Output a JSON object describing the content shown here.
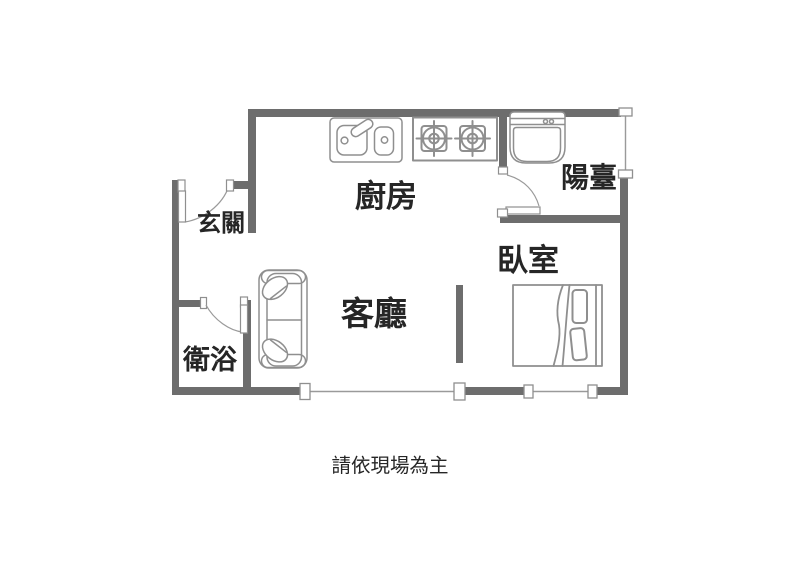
{
  "colors": {
    "wall": "#6d6d6d",
    "fixture": "#8f8f8f",
    "window": "#9a9a9a",
    "text": "#262626",
    "background": "#ffffff"
  },
  "rooms": {
    "entry": {
      "label": "玄關"
    },
    "kitchen": {
      "label": "廚房"
    },
    "balcony": {
      "label": "陽臺"
    },
    "living_room": {
      "label": "客廳"
    },
    "bedroom": {
      "label": "臥室"
    },
    "bathroom": {
      "label": "衛浴"
    }
  },
  "fixtures": [
    {
      "name": "kitchen-sink-icon",
      "room": "kitchen"
    },
    {
      "name": "gas-stove-icon",
      "room": "kitchen",
      "burners": 2
    },
    {
      "name": "washing-machine-icon",
      "room": "balcony"
    },
    {
      "name": "sofa-icon",
      "room": "living_room"
    },
    {
      "name": "double-bed-icon",
      "room": "bedroom"
    },
    {
      "name": "swing-door-icon",
      "room": "entry"
    },
    {
      "name": "swing-door-icon",
      "room": "bathroom"
    },
    {
      "name": "swing-door-icon",
      "room": "balcony"
    }
  ],
  "caption": {
    "text": "請依現場為主"
  }
}
